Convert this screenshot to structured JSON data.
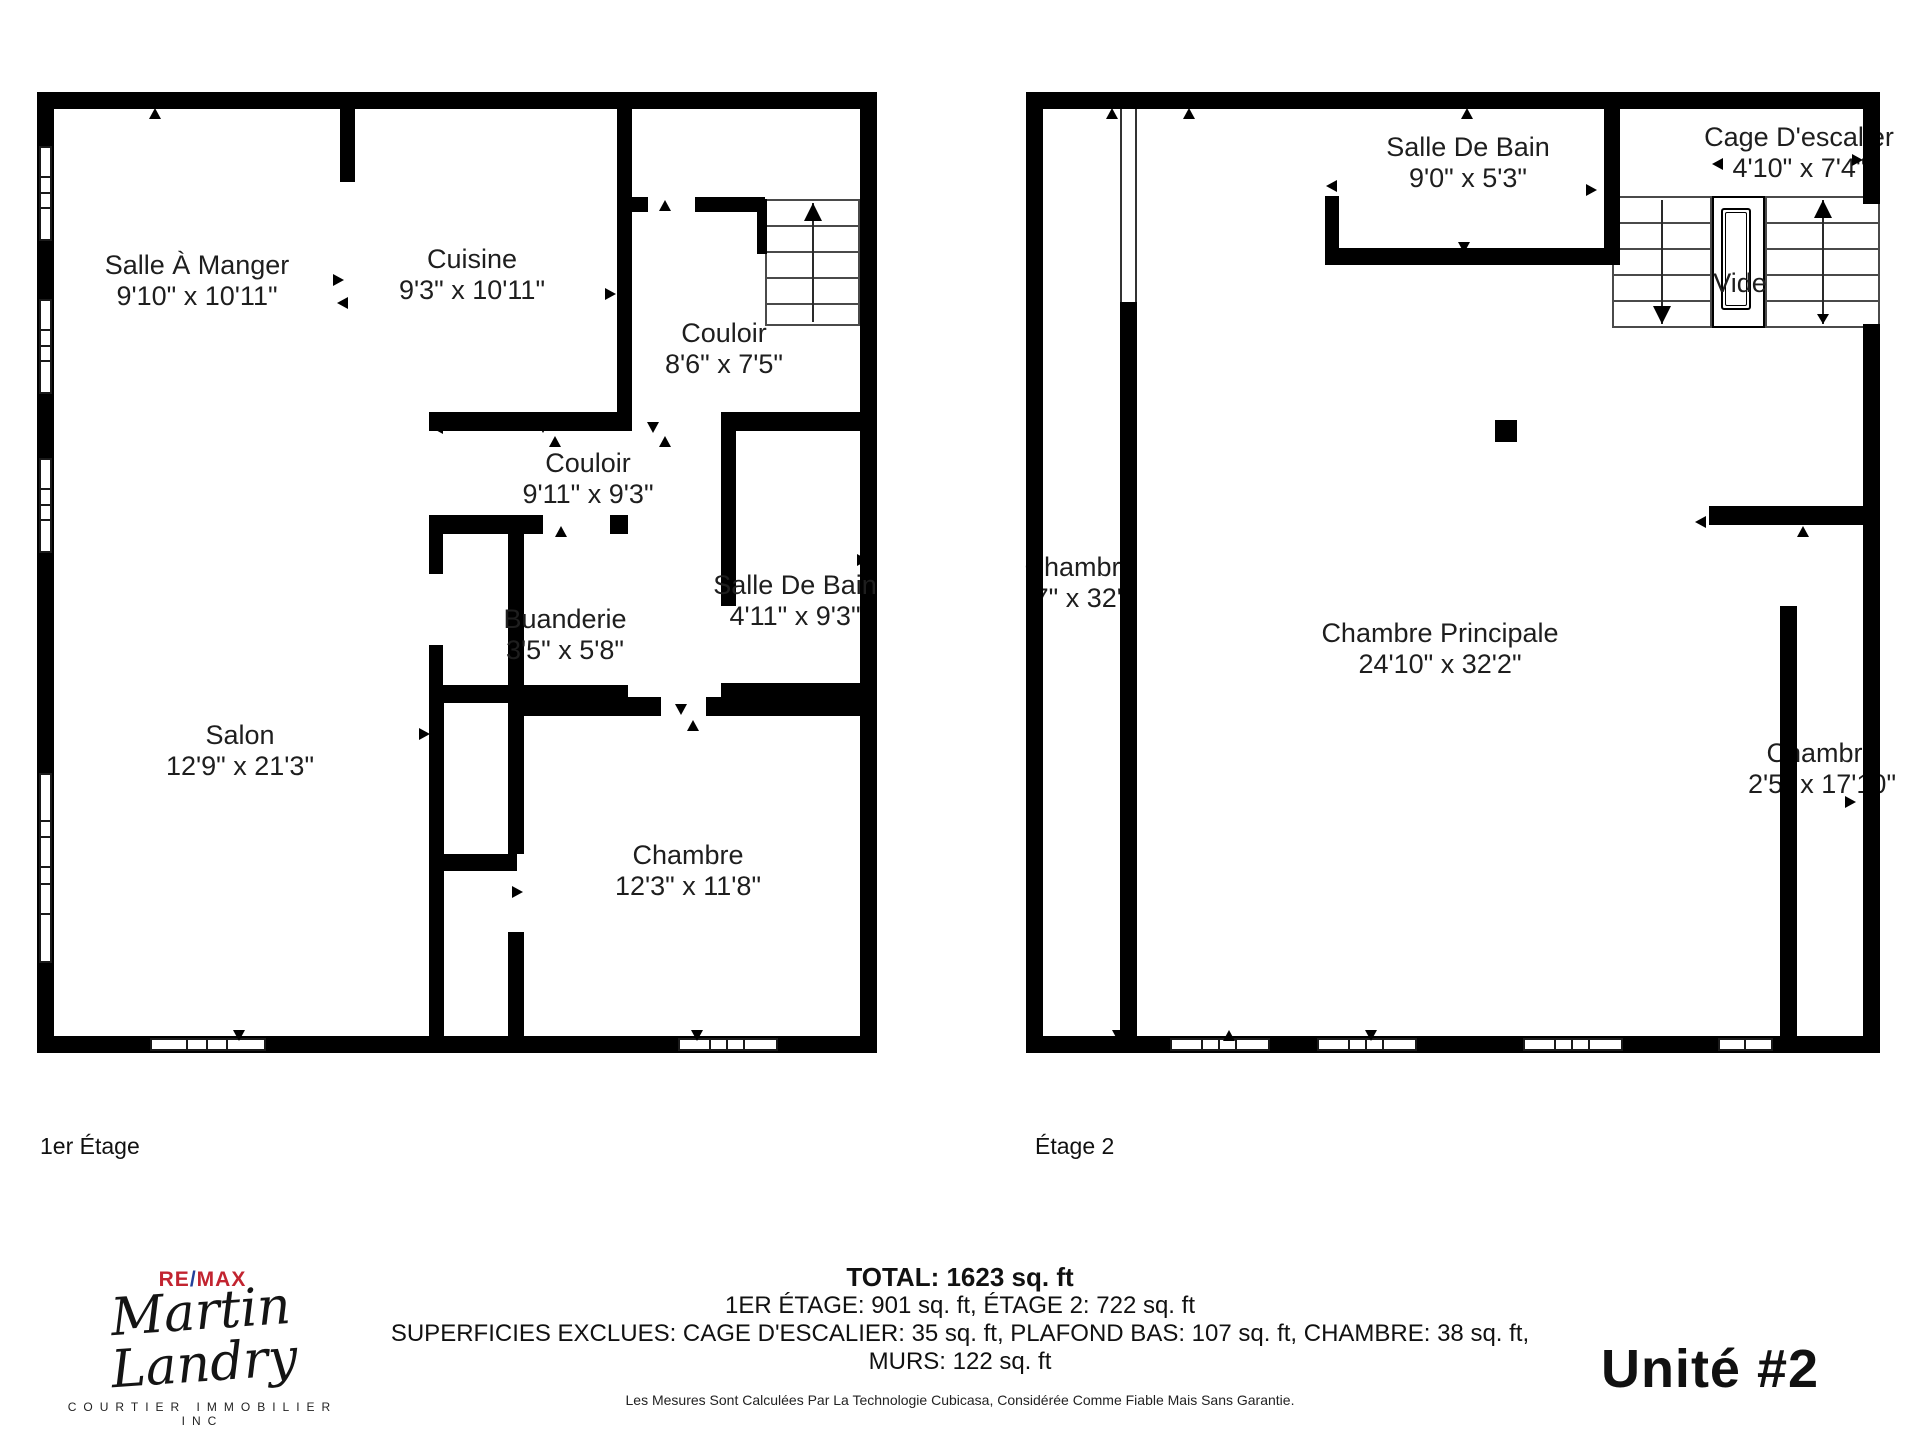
{
  "floor1": {
    "label": "1er Étage",
    "rooms": [
      {
        "name": "Salle À Manger",
        "dims": "9'10\" x 10'11\""
      },
      {
        "name": "Cuisine",
        "dims": "9'3\" x 10'11\""
      },
      {
        "name": "Couloir",
        "dims": "8'6\" x 7'5\""
      },
      {
        "name": "Couloir",
        "dims": "9'11\" x 9'3\""
      },
      {
        "name": "Buanderie",
        "dims": "3'5\" x 5'8\""
      },
      {
        "name": "Salle De Bain",
        "dims": "4'11\" x 9'3\""
      },
      {
        "name": "Salon",
        "dims": "12'9\" x 21'3\""
      },
      {
        "name": "Chambre",
        "dims": "12'3\" x 11'8\""
      }
    ]
  },
  "floor2": {
    "label": "Étage 2",
    "rooms": [
      {
        "name": "Salle De Bain",
        "dims": "9'0\" x 5'3\""
      },
      {
        "name": "Cage D'escalier",
        "dims": "4'10\" x 7'4\""
      },
      {
        "name": "Vide",
        "dims": ""
      },
      {
        "name": "Chambre",
        "dims": "'7\" x 32'\""
      },
      {
        "name": "Chambre Principale",
        "dims": "24'10\" x 32'2\""
      },
      {
        "name": "Chambre",
        "dims": "2'5\" x 17'10\""
      }
    ]
  },
  "footer": {
    "logo": {
      "brand_re": "RE",
      "brand_slash": "/",
      "brand_max": "MAX",
      "name": "Martin Landry",
      "subtitle": "COURTIER IMMOBILIER INC"
    },
    "total": "TOTAL: 1623 sq. ft",
    "line2": "1ER ÉTAGE: 901 sq. ft, ÉTAGE 2: 722 sq. ft",
    "line3": "SUPERFICIES EXCLUES: CAGE D'ESCALIER: 35 sq. ft, PLAFOND BAS: 107 sq. ft, CHAMBRE: 38 sq. ft,",
    "line4": "MURS: 122 sq. ft",
    "disclaimer": "Les Mesures Sont Calculées Par La Technologie Cubicasa, Considérée Comme Fiable Mais Sans Garantie.",
    "unit": "Unité #2"
  },
  "colors": {
    "wall": "#000000",
    "remax_red": "#c22430",
    "remax_blue": "#23409a",
    "text": "#1e1e1e"
  }
}
